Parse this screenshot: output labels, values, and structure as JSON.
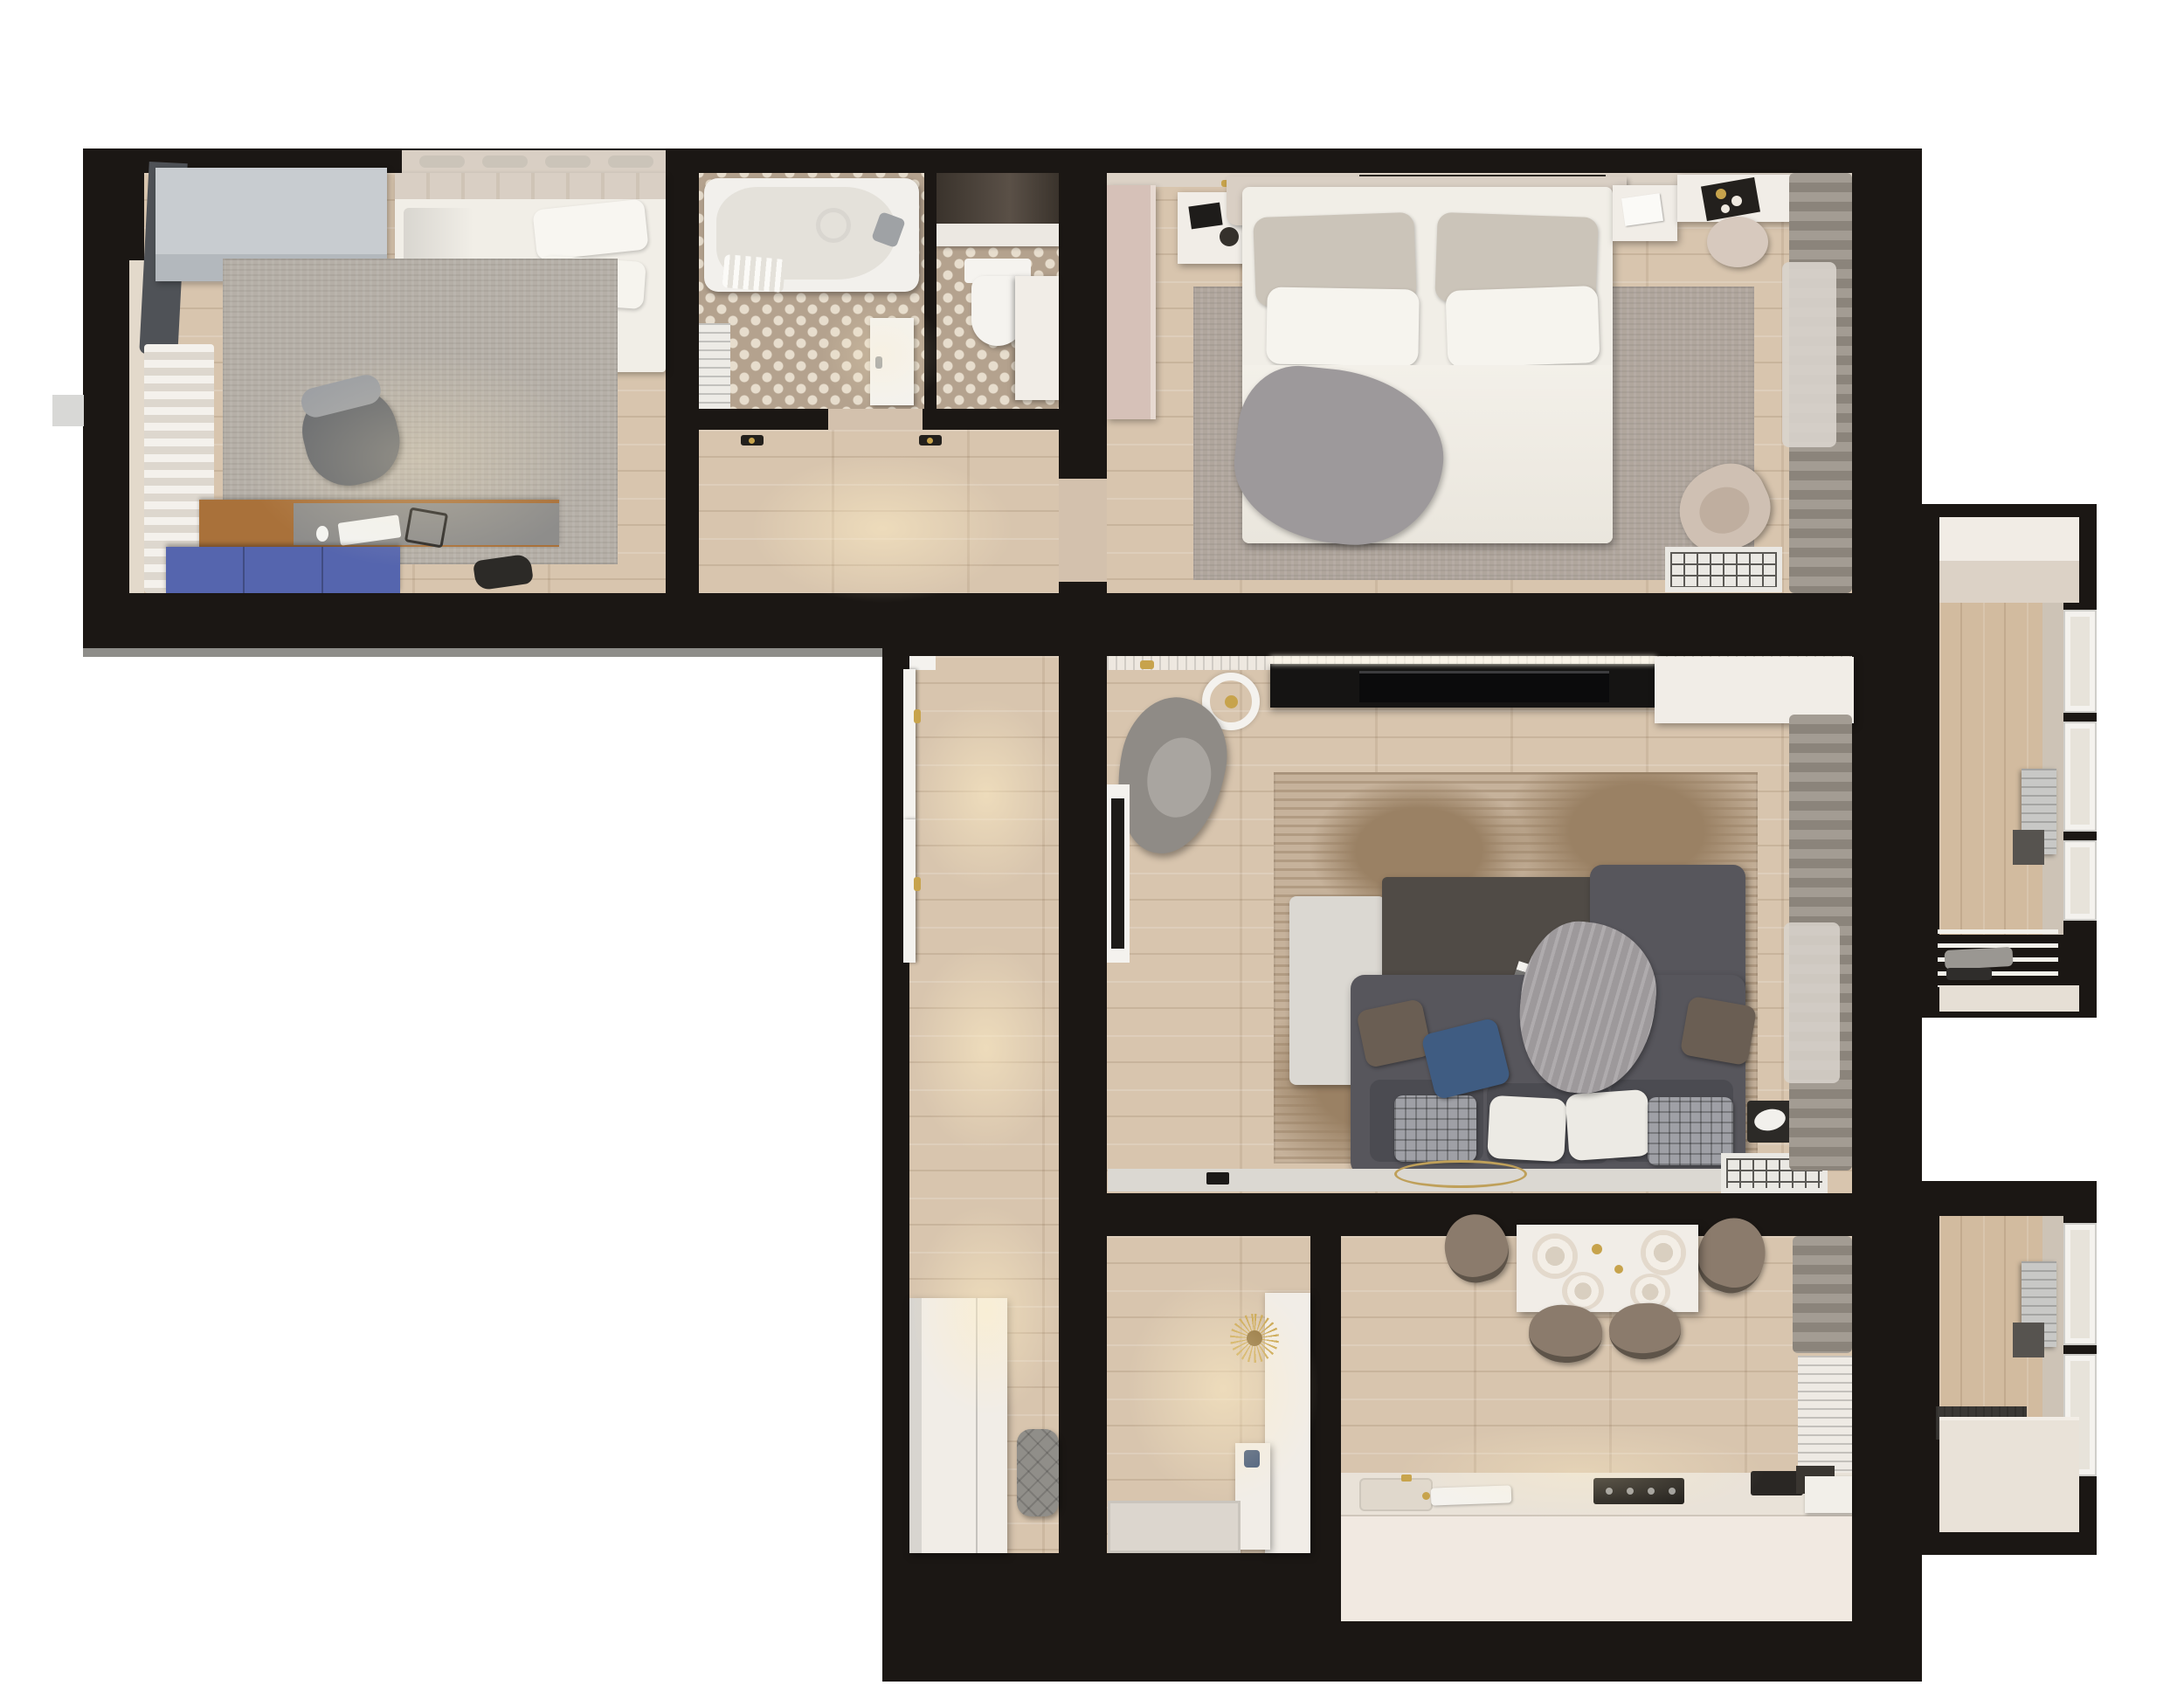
{
  "title": "apartment-floor-plan-3d-render",
  "palette": {
    "pageBg": "#ffffff",
    "wall": "#1b1714",
    "wallCap": "#8e8d89",
    "notch": "#d8d8d6",
    "floorWood": "#d8c5ae",
    "floorBalcony": "#d2bb9f",
    "sillBeige": "#e3d9cb",
    "curtainWhiteA": "#f4f1ec",
    "curtainWhiteB": "#ddd7ce",
    "curtainGrayA": "#a39c93",
    "curtainGrayB": "#8b847b",
    "sheer": "#d9d4cd",
    "darkCurtain": "#4f5257",
    "wardrobeGray": "#c8ccd0",
    "wardrobeGrayDark": "#b3b8bd",
    "bedWhite": "#f1eee7",
    "headboardBeige": "#d9cfc4",
    "pillowGray": "#cbc4b9",
    "throwGray": "#9d999b",
    "rugOffice": "#b5afa7",
    "rugBedroom": "#b0a69d",
    "rugLiving": "#c6b29b",
    "rugStreak": "#9a8164",
    "deskWood": "#a9713a",
    "deskMat": "#8e8d8b",
    "drawerBlue": "#5565ae",
    "chairOffice": "#64676c",
    "tileBase": "#b4a28e",
    "tileDot": "#e7ddcd",
    "tubWhite": "#f2f0ec",
    "tubInner": "#e4e1da",
    "chrome": "#9fa2a5",
    "doorWhite": "#f4f2ee",
    "windowGlass": "#e7e3da",
    "darkCabinet": "#3a332c",
    "furnWhite": "#f1ede7",
    "beigeDoorway": "#d3c1ad",
    "dresserPink": "#d6c1b8",
    "nicheDark": "#2b2721",
    "gold": "#c7a34c",
    "tvBlack": "#151413",
    "tvScreen": "#0b0b0c",
    "sofaGray": "#57565c",
    "sofaCushion": "#4b4b51",
    "pillowBlue": "#3f5c82",
    "pillowBrown": "#6a5e53",
    "pillowPlaid": "#9fa0a6",
    "pillowWhite": "#eceae4",
    "benchLight": "#dbd8d2",
    "tableDark": "#504b46",
    "acFrame": "#eae8e3",
    "acGrid": "#5b5955",
    "acBody": "#c8c8c6",
    "acDark": "#56534f",
    "loungeBeige": "#cfc0b3",
    "poufBeige": "#d7c9be",
    "chairTaupe": "#8b7b6c",
    "chairRim": "#5e5449",
    "counterTop": "#e9e2d8",
    "counterFace": "#f1e9e1",
    "cooktopBlack": "#1b1917",
    "matGray": "#dcd6ce",
    "poufQuilt": "#908e89",
    "decoBlue": "#44597a",
    "booksDark": "#2c2a27",
    "trimWhite": "#eee8e0",
    "faceBeige": "#dcd2c6",
    "bandCream": "#f1ece5",
    "balconyFace": "#cdc3b6",
    "benchDark": "#3a3835",
    "plateOut": "#e3d9cc",
    "plateMid": "#f3eee6",
    "plateIn": "#d9cfc0"
  },
  "rooms": [
    {
      "id": "office",
      "label": "office bedroom"
    },
    {
      "id": "bathroom",
      "label": "bathroom"
    },
    {
      "id": "wc",
      "label": "toilet room"
    },
    {
      "id": "inner-hall",
      "label": "inner hall"
    },
    {
      "id": "master-bedroom",
      "label": "master bedroom"
    },
    {
      "id": "living-room",
      "label": "living room"
    },
    {
      "id": "corridor",
      "label": "corridor"
    },
    {
      "id": "entry-hall",
      "label": "entry hall"
    },
    {
      "id": "kitchen",
      "label": "kitchen dining room"
    },
    {
      "id": "balcony-top",
      "label": "upper balcony"
    },
    {
      "id": "balcony-bottom",
      "label": "lower balcony"
    }
  ]
}
